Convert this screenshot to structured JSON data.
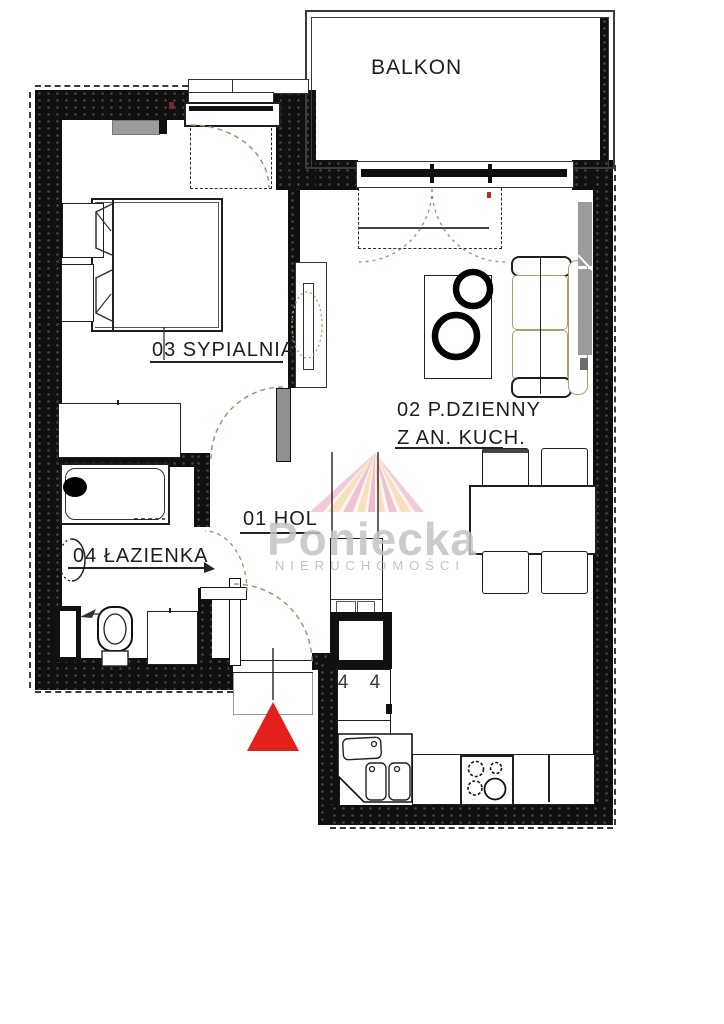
{
  "labels": {
    "balcony": "BALKON",
    "bedroom": "03 SYPIALNIA",
    "living_line1": "02 P.DZIENNY",
    "living_line2": "Z AN. KUCH.",
    "hall": "01 HOL",
    "bathroom": "04 ŁAZIENKA",
    "kitchen_cabinet_marks": "4 4"
  },
  "watermark": {
    "brand": "Poniecka",
    "subtitle": "NIERUCHOMOŚCI"
  },
  "colors": {
    "wall": "#101010",
    "entrance_marker_red": "#e3201b",
    "radiator_gray": "#9c9c9c",
    "door_arc_tan": "#a6926e",
    "watermark_gray": "#c3c3c3",
    "logo_pink": "#f0c3d1",
    "logo_peach": "#f6dcb2"
  }
}
